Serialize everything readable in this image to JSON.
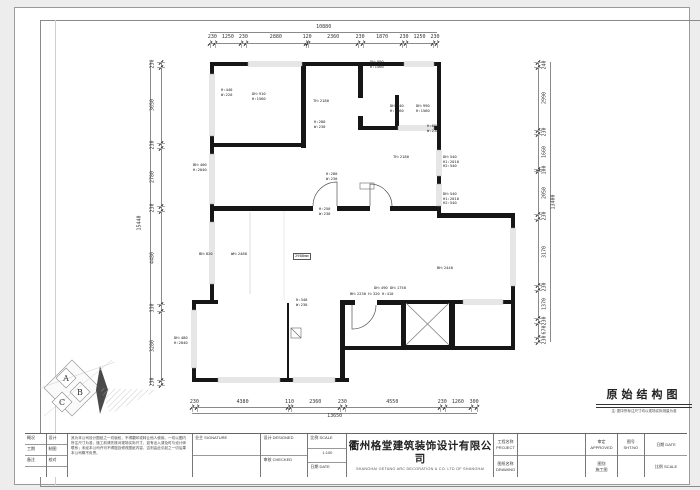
{
  "drawing_title": {
    "text": "原始结构图",
    "note": "注: 图中所标注尺寸均以现场实际测量为准"
  },
  "dims": {
    "top": {
      "total": "10880",
      "segments": [
        "230",
        "1250",
        "230",
        "2880",
        "120",
        "2360",
        "230",
        "1870",
        "230",
        "1250",
        "230"
      ]
    },
    "bottom": {
      "total": "13650",
      "segments": [
        "230",
        "4380",
        "110",
        "2360",
        "230",
        "4550",
        "230",
        "1260",
        "300"
      ]
    },
    "left": {
      "total": "15440",
      "segments": [
        "230",
        "3650",
        "230",
        "2780",
        "230",
        "4480",
        "330",
        "3280",
        "230"
      ]
    },
    "right": {
      "total": "13400",
      "segments": [
        "240",
        "2990",
        "230",
        "1660",
        "100",
        "2050",
        "230",
        "3170",
        "230",
        "1370",
        "230",
        "670",
        "230"
      ]
    }
  },
  "plan_labels": [
    {
      "x": 221,
      "y": 88,
      "t": [
        "H:440",
        "W:220"
      ]
    },
    {
      "x": 252,
      "y": 92,
      "t": [
        "DH:910",
        "H:1560"
      ]
    },
    {
      "x": 370,
      "y": 60,
      "t": [
        "DH:990",
        "H:1560"
      ]
    },
    {
      "x": 313,
      "y": 99,
      "t": [
        "TH:2180"
      ]
    },
    {
      "x": 390,
      "y": 104,
      "t": [
        "DH:940",
        "H:1560"
      ]
    },
    {
      "x": 416,
      "y": 104,
      "t": [
        "DH:990",
        "H:1560"
      ]
    },
    {
      "x": 427,
      "y": 124,
      "t": [
        "H:680",
        "W:230"
      ]
    },
    {
      "x": 314,
      "y": 120,
      "t": [
        "H:280",
        "W:230"
      ]
    },
    {
      "x": 326,
      "y": 172,
      "t": [
        "H:280",
        "W:230"
      ]
    },
    {
      "x": 319,
      "y": 207,
      "t": [
        "H:250",
        "W:230"
      ]
    },
    {
      "x": 193,
      "y": 163,
      "t": [
        "BH:400",
        "H:2040"
      ]
    },
    {
      "x": 199,
      "y": 252,
      "t": [
        "BH:820"
      ]
    },
    {
      "x": 231,
      "y": 252,
      "t": [
        "WH:2480"
      ]
    },
    {
      "x": 296,
      "y": 298,
      "t": [
        "H:340",
        "W:230"
      ]
    },
    {
      "x": 174,
      "y": 336,
      "t": [
        "DH:480",
        "H:2040"
      ]
    },
    {
      "x": 374,
      "y": 286,
      "t": [
        "DH:490 DH:1750"
      ]
    },
    {
      "x": 350,
      "y": 292,
      "t": [
        "BH:2230 H:320 H:410"
      ]
    },
    {
      "x": 443,
      "y": 155,
      "t": [
        "DH:540",
        "H1:2010",
        "H2:540"
      ]
    },
    {
      "x": 443,
      "y": 192,
      "t": [
        "DH:540",
        "H1:2010",
        "H2:540"
      ]
    },
    {
      "x": 437,
      "y": 266,
      "t": [
        "BH:2440"
      ]
    },
    {
      "x": 393,
      "y": 155,
      "t": [
        "TH:2180"
      ]
    },
    {
      "x": 293,
      "y": 253,
      "t": [
        "2900mm"
      ],
      "box": true
    }
  ],
  "logo": {
    "letters": [
      "A",
      "B",
      "C"
    ]
  },
  "title_block": {
    "grid_a": [
      "概况",
      "工期",
      "备注",
      ""
    ],
    "grid_b": [
      "设计",
      "制图",
      "校对",
      ""
    ],
    "notes_label": "说明  NOTES",
    "notes": "其为本公司设计图纸之一切版权，不得翻印或转让他人使用。一切以图内所注尺寸为准，施工前请先核对现场实际尺寸，如有出入请及时与设计师联系；未经本公司许可不得擅自修改图纸内容，否则由此引起之一切后果本公司概不负责。",
    "owner_label": "业主  SIGNATURE",
    "design_label": "设计  DESIGNED",
    "check_label": "审核  CHECKED",
    "scale_label": "比例  SCALE",
    "scale_value": "1:100",
    "date_label": "日期  DATE",
    "company_cn": "衢州格堂建筑装饰设计有限公司",
    "company_en": "SHANGHAI GETANG ARC DECORATION  &  CO. LTD OF SHANGHAI",
    "project_label": "工程名称",
    "project_en": "PROJECT",
    "drawing_label": "图纸名称",
    "drawing_en": "DRAWING",
    "approved_label": "审定",
    "approved_en": "APPROVED",
    "sheet_label": "图号",
    "sheet_en": "SHT.NO",
    "type_label": "图别",
    "type_value": "施工图"
  }
}
